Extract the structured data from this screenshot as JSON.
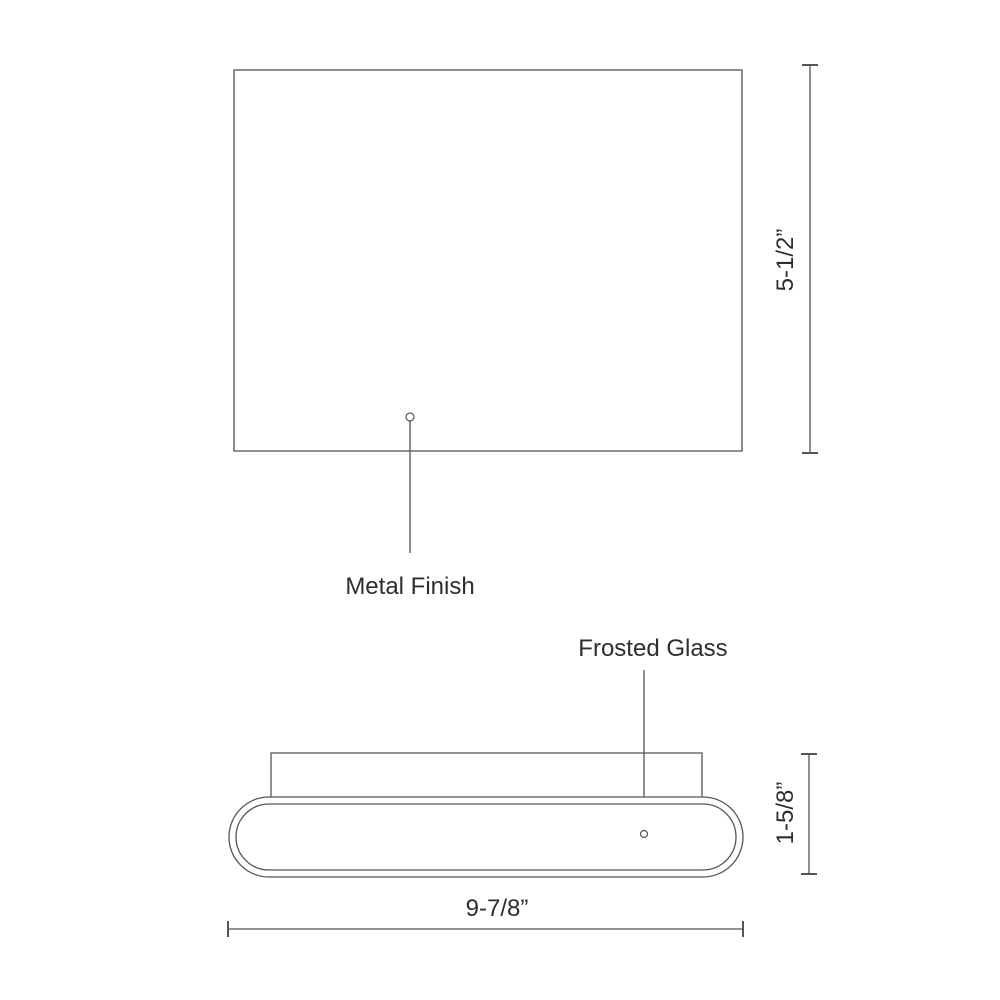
{
  "diagram": {
    "kind": "product-dimension-drawing",
    "annotations": {
      "metal_finish": "Metal Finish",
      "frosted_glass": "Frosted Glass"
    },
    "dimensions": {
      "front_height": "5-1/2”",
      "profile_height": "1-5/8”",
      "width": "9-7/8”"
    }
  },
  "colors": {
    "line": "#555555",
    "text": "#2e2e2e",
    "background": "#ffffff"
  }
}
